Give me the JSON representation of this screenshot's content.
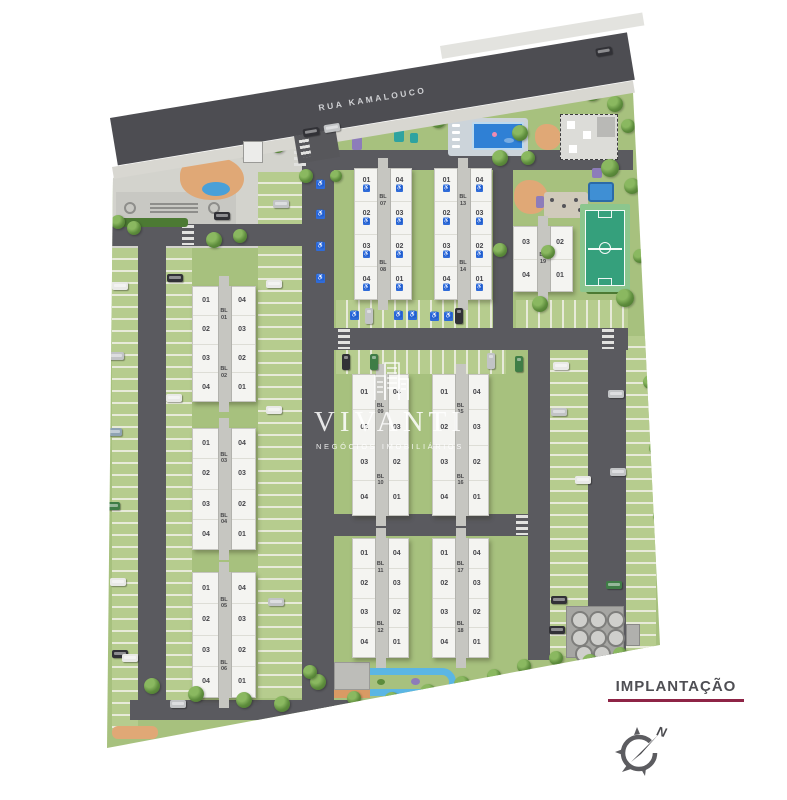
{
  "street": {
    "name": "RUA KAMALOUCO"
  },
  "watermark": {
    "brand": "VIVANTI",
    "tagline": "NEGÓCIOS IMOBILIÁRIOS"
  },
  "legend": {
    "title": "IMPLANTAÇÃO"
  },
  "compass": {
    "north_label": "N"
  },
  "icons": {
    "accessibility": "♿"
  },
  "palette": {
    "accent_maroon": "#8e2446",
    "accessibility_blue": "#2f6bd8",
    "road_gray": "#5a5a5f",
    "lawn_green": "#a7c17e",
    "court_green": "#35a07c",
    "pool_blue": "#2f80d5",
    "car_colors": {
      "white": "#e9e9e7",
      "silver": "#c2c4c6",
      "steel": "#8fa3b4",
      "green": "#3f7d46",
      "dark": "#313136"
    }
  },
  "site": {
    "towers": [
      {
        "bl_top": "BL\n01",
        "bl_bottom": "BL\n02",
        "left_units": [
          "01",
          "02",
          "03",
          "04"
        ],
        "right_units": [
          "04",
          "03",
          "02",
          "01"
        ],
        "accessible": false,
        "half": false,
        "x": 192,
        "y": 286,
        "w": 64,
        "h": 116
      },
      {
        "bl_top": "BL\n03",
        "bl_bottom": "BL\n04",
        "left_units": [
          "01",
          "02",
          "03",
          "04"
        ],
        "right_units": [
          "04",
          "03",
          "02",
          "01"
        ],
        "accessible": false,
        "half": false,
        "x": 192,
        "y": 428,
        "w": 64,
        "h": 122
      },
      {
        "bl_top": "BL\n05",
        "bl_bottom": "BL\n06",
        "left_units": [
          "01",
          "02",
          "03",
          "04"
        ],
        "right_units": [
          "04",
          "03",
          "02",
          "01"
        ],
        "accessible": false,
        "half": false,
        "x": 192,
        "y": 572,
        "w": 64,
        "h": 126
      },
      {
        "bl_top": "BL\n07",
        "bl_bottom": "BL\n08",
        "left_units": [
          "01",
          "02",
          "03",
          "04"
        ],
        "right_units": [
          "04",
          "03",
          "02",
          "01"
        ],
        "accessible": true,
        "half": false,
        "x": 354,
        "y": 168,
        "w": 58,
        "h": 132
      },
      {
        "bl_top": "BL\n13",
        "bl_bottom": "BL\n14",
        "left_units": [
          "01",
          "02",
          "03",
          "04"
        ],
        "right_units": [
          "04",
          "03",
          "02",
          "01"
        ],
        "accessible": true,
        "half": false,
        "x": 434,
        "y": 168,
        "w": 58,
        "h": 132
      },
      {
        "bl_top": "BL\n19",
        "bl_bottom": null,
        "left_units": [
          "03",
          "04"
        ],
        "right_units": [
          "02",
          "01"
        ],
        "accessible": false,
        "half": true,
        "x": 513,
        "y": 226,
        "w": 60,
        "h": 66
      },
      {
        "bl_top": "BL\n09",
        "bl_bottom": "BL\n10",
        "left_units": [
          "01",
          "02",
          "03",
          "04"
        ],
        "right_units": [
          "04",
          "03",
          "02",
          "01"
        ],
        "accessible": false,
        "half": false,
        "x": 352,
        "y": 374,
        "w": 57,
        "h": 142
      },
      {
        "bl_top": "BL\n15",
        "bl_bottom": "BL\n16",
        "left_units": [
          "01",
          "02",
          "03",
          "04"
        ],
        "right_units": [
          "04",
          "03",
          "02",
          "01"
        ],
        "accessible": false,
        "half": false,
        "x": 432,
        "y": 374,
        "w": 57,
        "h": 142
      },
      {
        "bl_top": "BL\n11",
        "bl_bottom": "BL\n12",
        "left_units": [
          "01",
          "02",
          "03",
          "04"
        ],
        "right_units": [
          "04",
          "03",
          "02",
          "01"
        ],
        "accessible": false,
        "half": false,
        "x": 352,
        "y": 538,
        "w": 57,
        "h": 120
      },
      {
        "bl_top": "BL\n17",
        "bl_bottom": "BL\n18",
        "left_units": [
          "01",
          "02",
          "03",
          "04"
        ],
        "right_units": [
          "04",
          "03",
          "02",
          "01"
        ],
        "accessible": false,
        "half": false,
        "x": 432,
        "y": 538,
        "w": 57,
        "h": 120
      }
    ],
    "trees": [
      [
        248,
        150,
        9
      ],
      [
        262,
        136,
        8
      ],
      [
        278,
        146,
        7
      ],
      [
        300,
        133,
        8
      ],
      [
        318,
        142,
        7
      ],
      [
        340,
        118,
        9
      ],
      [
        358,
        103,
        8
      ],
      [
        377,
        124,
        8
      ],
      [
        398,
        109,
        9
      ],
      [
        420,
        98,
        8
      ],
      [
        438,
        120,
        8
      ],
      [
        456,
        92,
        7
      ],
      [
        470,
        86,
        7
      ],
      [
        540,
        90,
        8
      ],
      [
        560,
        86,
        7
      ],
      [
        592,
        92,
        9
      ],
      [
        615,
        104,
        8
      ],
      [
        628,
        126,
        7
      ],
      [
        520,
        133,
        8
      ],
      [
        500,
        158,
        8
      ],
      [
        528,
        158,
        7
      ],
      [
        610,
        168,
        9
      ],
      [
        632,
        186,
        8
      ],
      [
        648,
        222,
        8
      ],
      [
        640,
        256,
        7
      ],
      [
        652,
        300,
        8
      ],
      [
        625,
        298,
        9
      ],
      [
        540,
        304,
        8
      ],
      [
        500,
        250,
        7
      ],
      [
        548,
        252,
        7
      ],
      [
        118,
        222,
        7
      ],
      [
        134,
        228,
        7
      ],
      [
        214,
        240,
        8
      ],
      [
        240,
        236,
        7
      ],
      [
        152,
        686,
        8
      ],
      [
        196,
        694,
        8
      ],
      [
        244,
        700,
        8
      ],
      [
        282,
        704,
        8
      ],
      [
        318,
        682,
        8
      ],
      [
        354,
        698,
        7
      ],
      [
        392,
        700,
        8
      ],
      [
        428,
        692,
        8
      ],
      [
        462,
        684,
        8
      ],
      [
        494,
        676,
        7
      ],
      [
        524,
        666,
        7
      ],
      [
        556,
        658,
        7
      ],
      [
        590,
        662,
        8
      ],
      [
        620,
        654,
        7
      ],
      [
        650,
        382,
        7
      ],
      [
        656,
        448,
        7
      ],
      [
        660,
        516,
        7
      ],
      [
        310,
        672,
        7
      ],
      [
        306,
        176,
        7
      ],
      [
        336,
        176,
        6
      ]
    ],
    "cars": [
      [
        112,
        282,
        "white",
        0
      ],
      [
        108,
        352,
        "silver",
        0
      ],
      [
        106,
        428,
        "steel",
        0
      ],
      [
        104,
        502,
        "green",
        0
      ],
      [
        110,
        578,
        "white",
        0
      ],
      [
        112,
        650,
        "dark",
        0
      ],
      [
        167,
        274,
        "dark",
        0
      ],
      [
        166,
        394,
        "white",
        0
      ],
      [
        266,
        280,
        "white",
        0
      ],
      [
        266,
        406,
        "white",
        0
      ],
      [
        268,
        598,
        "silver",
        0
      ],
      [
        170,
        700,
        "silver",
        0
      ],
      [
        122,
        654,
        "white",
        0
      ],
      [
        365,
        308,
        "silver",
        1
      ],
      [
        455,
        308,
        "dark",
        1
      ],
      [
        342,
        354,
        "dark",
        1
      ],
      [
        370,
        354,
        "green",
        1
      ],
      [
        487,
        353,
        "silver",
        1
      ],
      [
        515,
        356,
        "green",
        1
      ],
      [
        553,
        362,
        "white",
        0
      ],
      [
        551,
        408,
        "silver",
        0
      ],
      [
        575,
        476,
        "white",
        0
      ],
      [
        608,
        390,
        "silver",
        0
      ],
      [
        610,
        468,
        "silver",
        0
      ],
      [
        606,
        581,
        "green",
        0
      ],
      [
        551,
        596,
        "dark",
        0
      ],
      [
        549,
        626,
        "dark",
        0
      ],
      [
        214,
        212,
        "dark",
        0
      ],
      [
        273,
        200,
        "silver",
        0
      ]
    ],
    "street_cars": [
      [
        490,
        11,
        "dark"
      ]
    ],
    "entry_cars": [
      [
        303,
        128,
        "dark"
      ],
      [
        324,
        124,
        "silver"
      ]
    ],
    "accessible_spots": [
      [
        350,
        311
      ],
      [
        394,
        311
      ],
      [
        408,
        311
      ],
      [
        430,
        312
      ],
      [
        444,
        312
      ],
      [
        316,
        180
      ],
      [
        316,
        210
      ],
      [
        316,
        242
      ],
      [
        316,
        274
      ]
    ],
    "tanks": {
      "x": 566,
      "y": 606,
      "circles": [
        [
          4,
          4
        ],
        [
          22,
          4
        ],
        [
          40,
          4
        ],
        [
          4,
          22
        ],
        [
          22,
          22
        ],
        [
          40,
          22
        ],
        [
          8,
          38
        ],
        [
          26,
          38
        ]
      ]
    }
  }
}
